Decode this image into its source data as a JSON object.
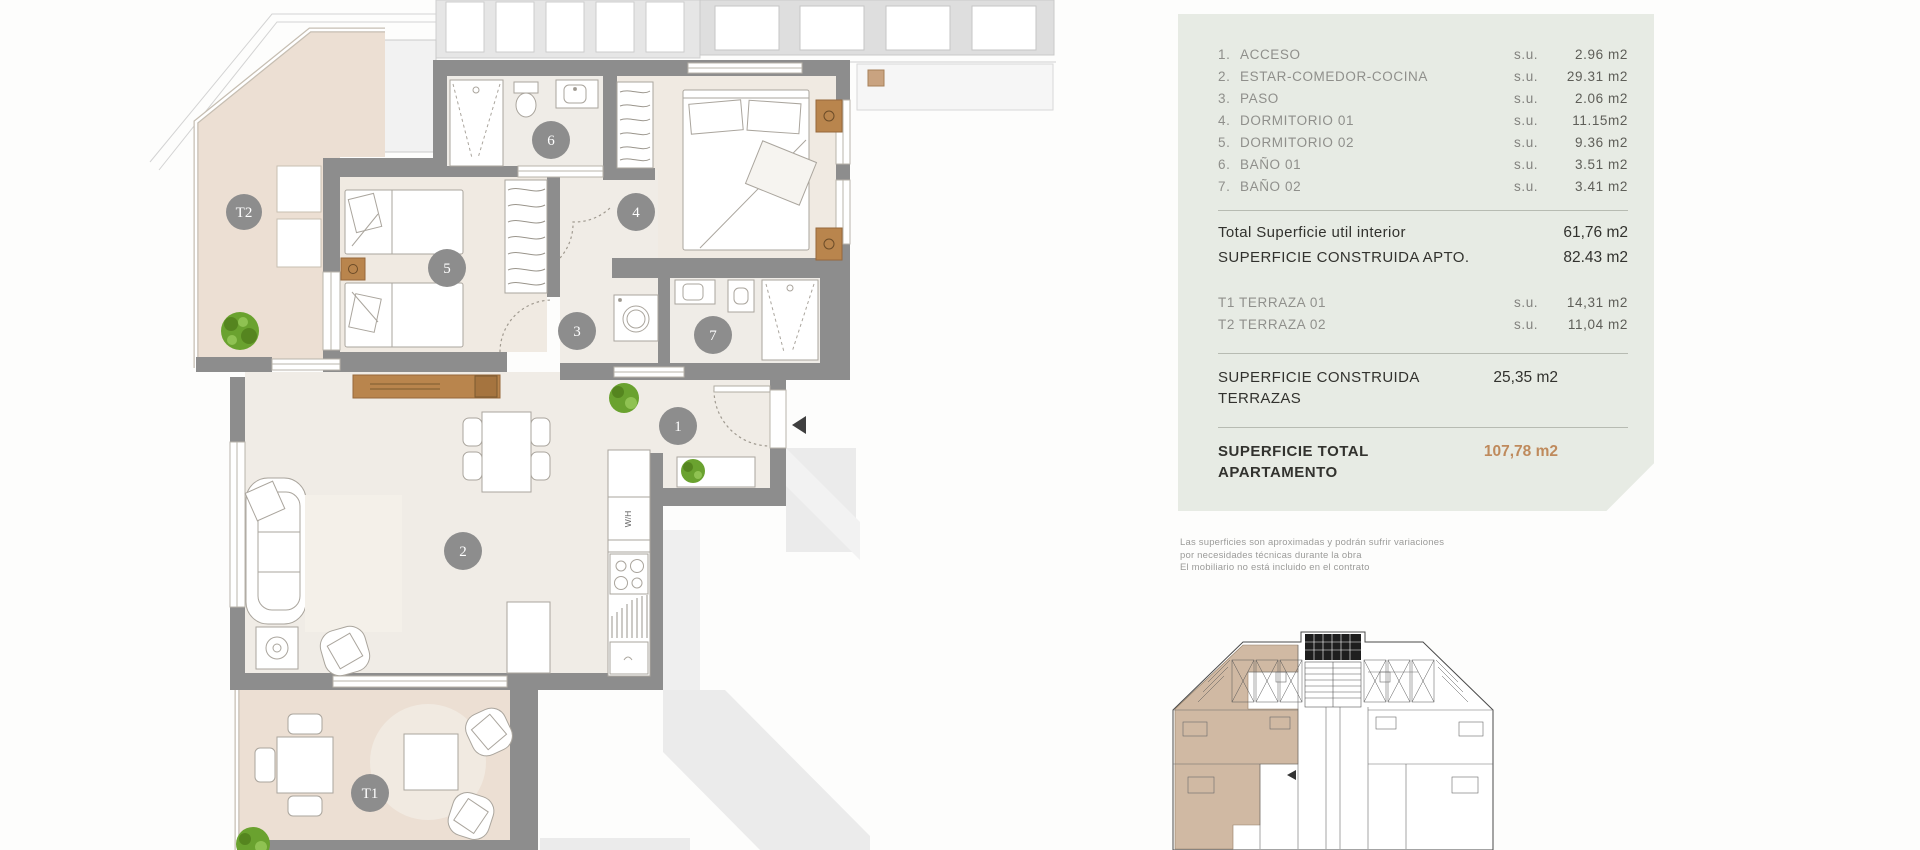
{
  "panel": {
    "rooms": [
      {
        "num": "1.",
        "label": "ACCESO",
        "su": "s.u.",
        "value": "2.96 m2"
      },
      {
        "num": "2.",
        "label": "ESTAR-COMEDOR-COCINA",
        "su": "s.u.",
        "value": "29.31 m2"
      },
      {
        "num": "3.",
        "label": "PASO",
        "su": "s.u.",
        "value": "2.06 m2"
      },
      {
        "num": "4.",
        "label": "DORMITORIO 01",
        "su": "s.u.",
        "value": "11.15m2"
      },
      {
        "num": "5.",
        "label": "DORMITORIO 02",
        "su": "s.u.",
        "value": "9.36 m2"
      },
      {
        "num": "6.",
        "label": "BAÑO 01",
        "su": "s.u.",
        "value": "3.51 m2"
      },
      {
        "num": "7.",
        "label": "BAÑO 02",
        "su": "s.u.",
        "value": "3.41 m2"
      }
    ],
    "total_util": {
      "label": "Total Superficie util interior",
      "value": "61,76 m2"
    },
    "construida_apto": {
      "label": "SUPERFICIE CONSTRUIDA APTO.",
      "value": "82.43 m2"
    },
    "terrazas": [
      {
        "label": "T1 TERRAZA 01",
        "su": "s.u.",
        "value": "14,31 m2"
      },
      {
        "label": "T2 TERRAZA 02",
        "su": "s.u.",
        "value": "11,04 m2"
      }
    ],
    "construida_terrazas": {
      "label": "SUPERFICIE CONSTRUIDA TERRAZAS",
      "value": "25,35 m2"
    },
    "total_apartamento": {
      "label": "SUPERFICIE TOTAL APARTAMENTO",
      "value": "107,78 m2"
    }
  },
  "disclaimer": {
    "line1": "Las superficies son aproximadas y podrán sufrir variaciones",
    "line2": "por necesidades técnicas durante la obra",
    "line3": "El mobiliario no está incluido en el contrato"
  },
  "floorplan": {
    "circles": {
      "c1": "1",
      "c2": "2",
      "c3": "3",
      "c4": "4",
      "c5": "5",
      "c6": "6",
      "c7": "7",
      "t1": "T1",
      "t2": "T2"
    },
    "kitchen_label": "W/H"
  },
  "colors": {
    "panel_bg": "#e7ebe4",
    "accent_total": "#bf8a5c",
    "wall_gray": "#8d8d8d",
    "terrace_floor": "#ecdfd3",
    "interior_floor": "#f0ece6",
    "keyplan_highlight": "#cdb49c",
    "plant_green": "#6aa22f",
    "wood": "#b9854d"
  }
}
